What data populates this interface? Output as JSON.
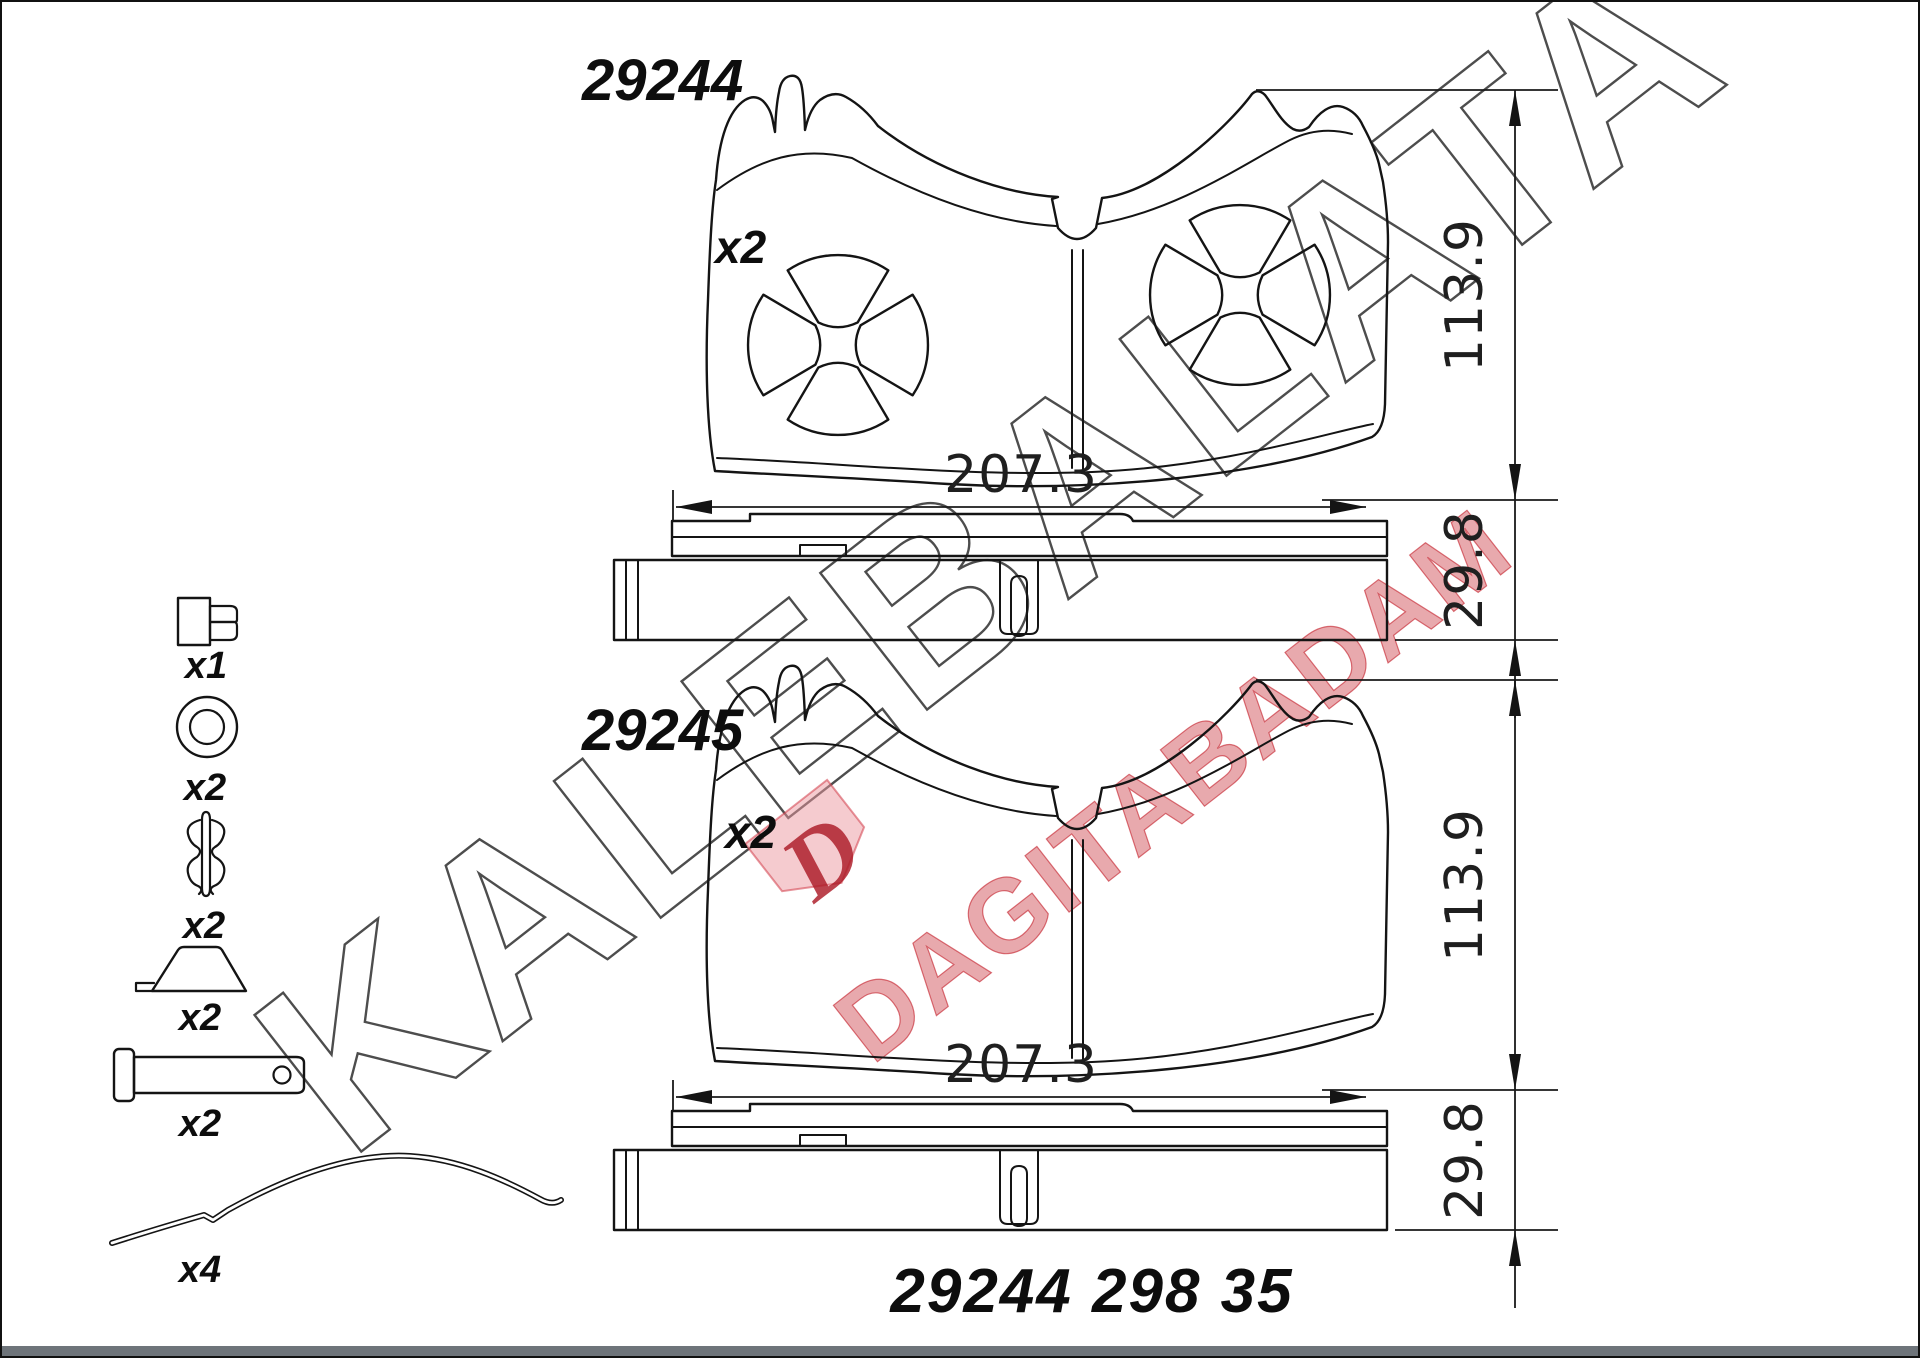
{
  "page": {
    "background": "#ffffff",
    "border_color": "#111111",
    "footer_bar_color": "#6e747a"
  },
  "watermark": {
    "brand_text": "KALEBALATA",
    "secondary_text": "DAGITABADAM",
    "logo_letter": "D",
    "outline_color": "#3a3a3a",
    "accent_color": "#c32734"
  },
  "drawings": [
    {
      "part_number": "29244",
      "quantity": "x2",
      "width_mm": "207.3",
      "height_mm": "113.9",
      "thickness_mm": "29.8"
    },
    {
      "part_number": "29245",
      "quantity": "x2",
      "width_mm": "207.3",
      "height_mm": "113.9",
      "thickness_mm": "29.8"
    }
  ],
  "hardware_items": [
    {
      "name": "mounting-bolt",
      "quantity": "x1"
    },
    {
      "name": "washer",
      "quantity": "x2"
    },
    {
      "name": "retaining-clip",
      "quantity": "x2"
    },
    {
      "name": "guide-wedge",
      "quantity": "x2"
    },
    {
      "name": "clevis-pin",
      "quantity": "x2"
    },
    {
      "name": "pad-retainer-spring",
      "quantity": "x4"
    }
  ],
  "footer": {
    "reference_code": "29244 298 35"
  }
}
